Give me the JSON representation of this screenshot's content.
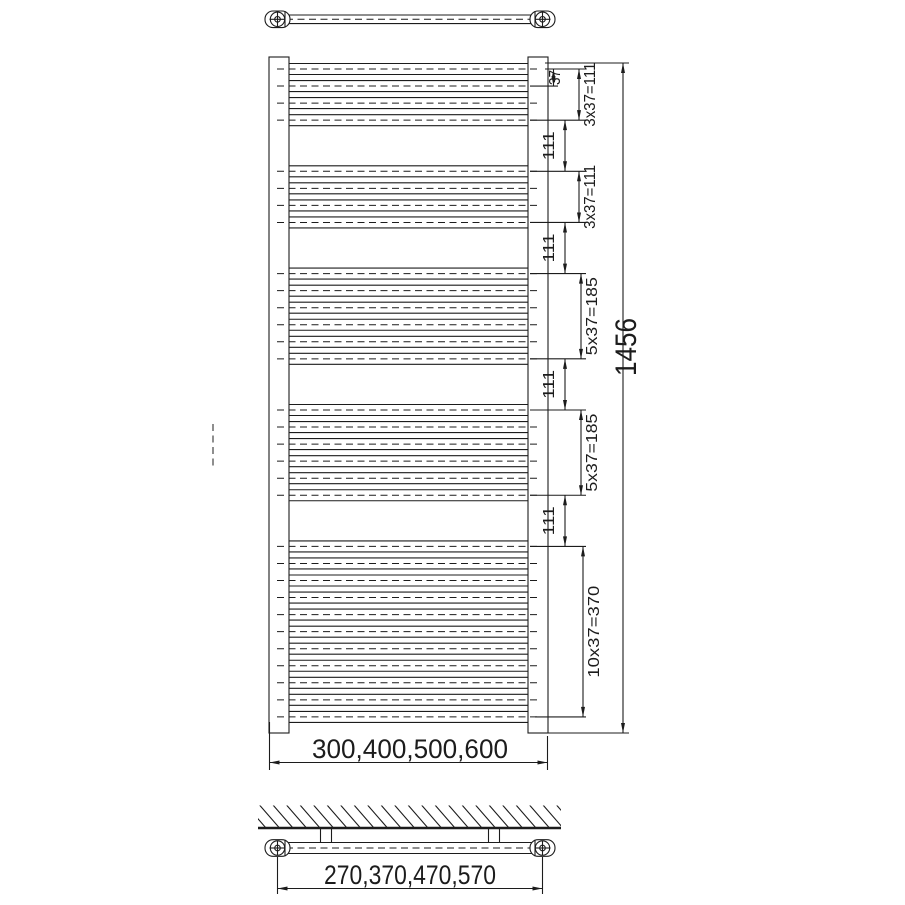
{
  "drawing": {
    "colors": {
      "line": "#1c1c1c",
      "background": "#ffffff"
    },
    "front_view": {
      "overall_height": "1456",
      "overall_width_options": "300,400,500,600",
      "first_tube_gap": "37",
      "group_gap": "111",
      "groups": [
        {
          "tube_count": 4,
          "span_label": "3x37=111"
        },
        {
          "tube_count": 4,
          "span_label": "3x37=111"
        },
        {
          "tube_count": 6,
          "span_label": "5x37=185"
        },
        {
          "tube_count": 6,
          "span_label": "5x37=185"
        },
        {
          "tube_count": 11,
          "span_label": "10x37=370"
        }
      ]
    },
    "wall_view": {
      "bracket_distance_options": "270,370,470,570"
    }
  }
}
